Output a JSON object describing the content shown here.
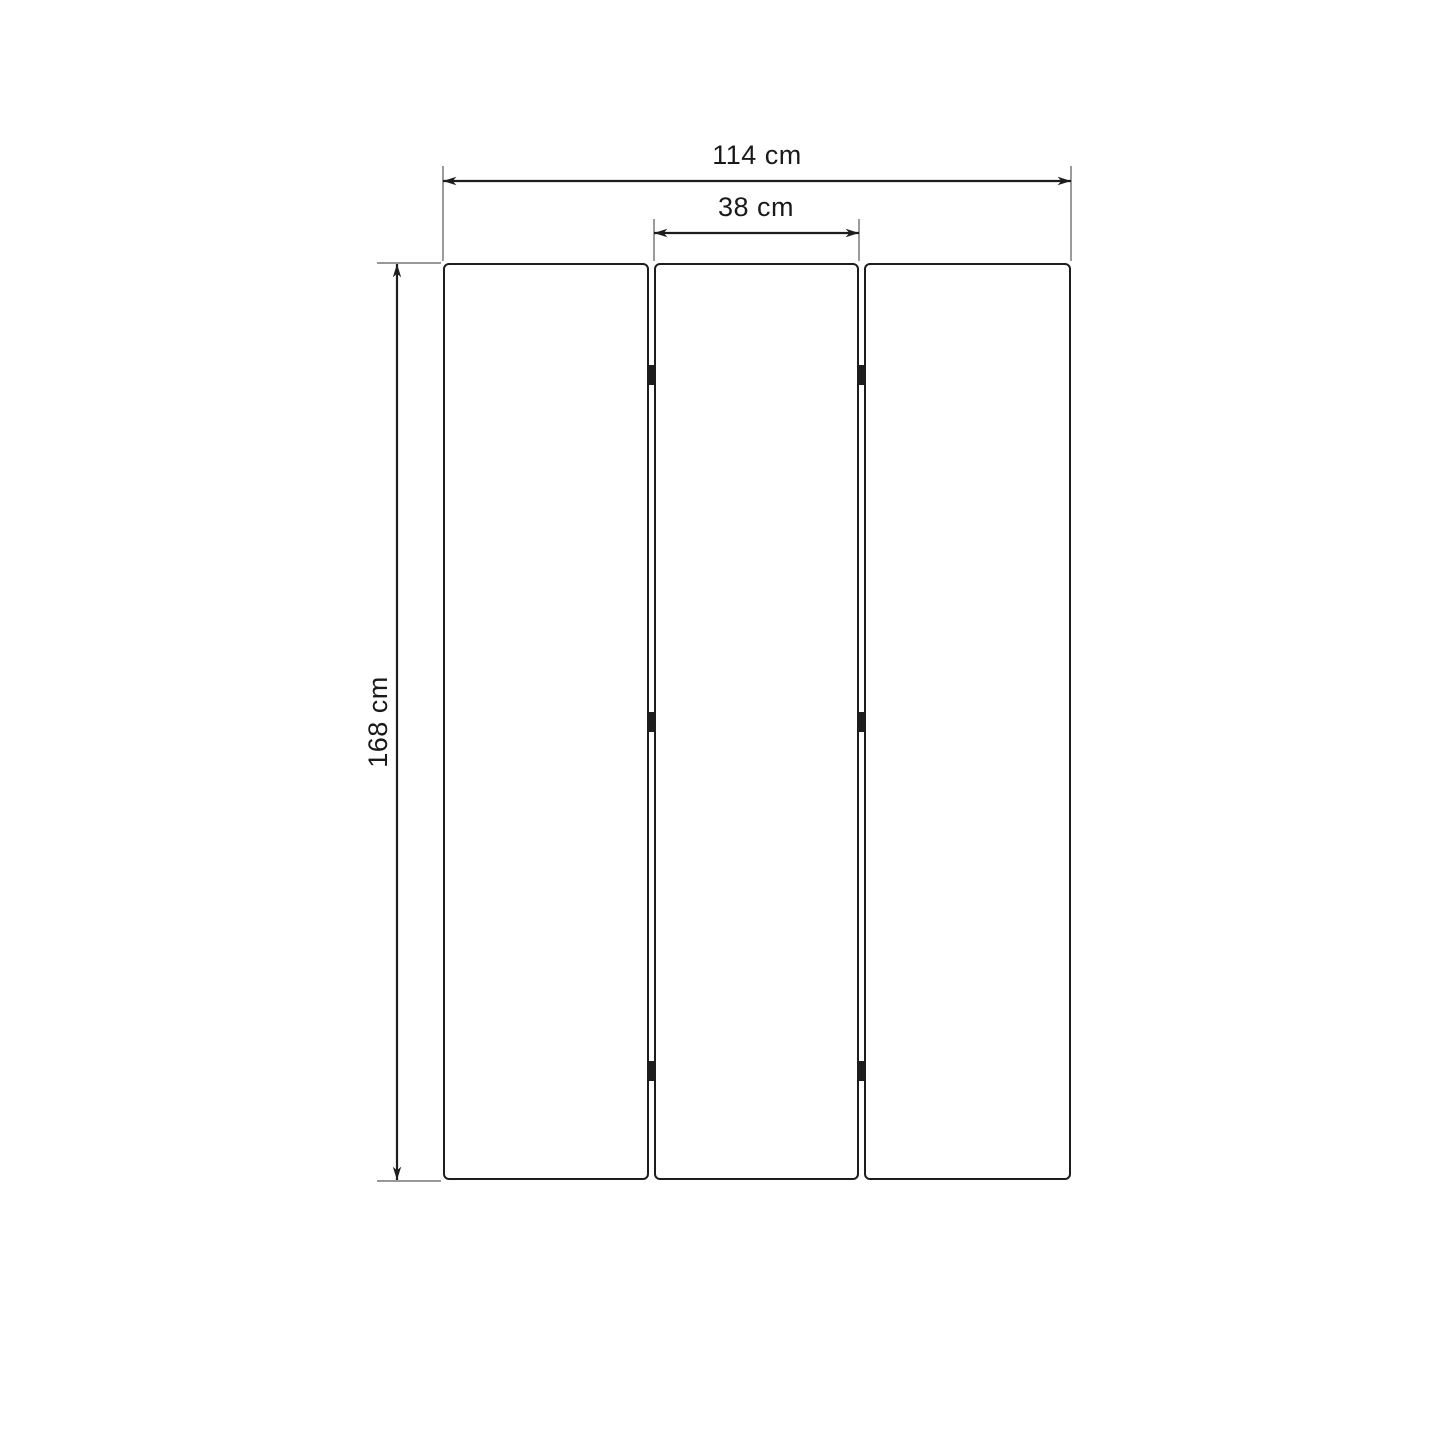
{
  "colors": {
    "background": "#ffffff",
    "outline": "#1d1d1d",
    "extension_line": "#5a5a5a",
    "panel_fill": "#ffffff",
    "hinge_fill": "#1d1d1d",
    "label_text": "#1a1a1a"
  },
  "structure": {
    "panel_count": 3,
    "hinges_per_gap": 3
  },
  "dimensions": {
    "total_width": {
      "label": "114 cm",
      "value": 114,
      "unit": "cm"
    },
    "panel_width": {
      "label": "38 cm",
      "value": 38,
      "unit": "cm"
    },
    "height": {
      "label": "168 cm",
      "value": 168,
      "unit": "cm"
    }
  }
}
